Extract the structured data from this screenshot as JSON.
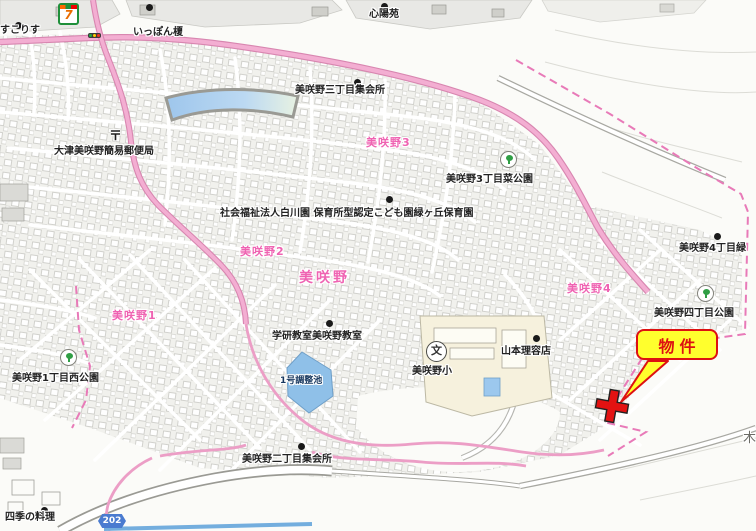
{
  "map": {
    "title": "美咲野住宅地図",
    "callout": {
      "text": "物件"
    },
    "road_badge": {
      "text": "202"
    },
    "colors": {
      "district_pink": "#ef63b2",
      "road_pink": "#f3aed2",
      "boundary_pink": "#e87ab8",
      "water_blue": "#8fc0e8",
      "callout_yellow": "#ffff2d",
      "callout_red": "#dd1111",
      "marker_red": "#e31212"
    },
    "labels": [
      {
        "text": "すこりす",
        "cls": "place",
        "x": 0,
        "y": 25
      },
      {
        "text": "いっぽん榎",
        "cls": "place",
        "x": 133,
        "y": 27
      },
      {
        "text": "心陽苑",
        "cls": "place",
        "x": 369,
        "y": 9
      },
      {
        "text": "美咲野三丁目集会所",
        "cls": "place",
        "x": 295,
        "y": 85
      },
      {
        "text": "美咲野3",
        "cls": "district",
        "x": 366,
        "y": 137
      },
      {
        "text": "美咲野3丁目菜公園",
        "cls": "place",
        "x": 446,
        "y": 174
      },
      {
        "text": "大津美咲野簡易郵便局",
        "cls": "place",
        "x": 54,
        "y": 146
      },
      {
        "text": "社会福祉法人白川園 保育所型認定こども園緑ヶ丘保育園",
        "cls": "place",
        "x": 220,
        "y": 208
      },
      {
        "text": "美咲野2",
        "cls": "district",
        "x": 240,
        "y": 246
      },
      {
        "text": "美咲野",
        "cls": "district-large",
        "x": 299,
        "y": 271
      },
      {
        "text": "美咲野4",
        "cls": "district",
        "x": 567,
        "y": 283
      },
      {
        "text": "美咲野4丁目緑",
        "cls": "place",
        "x": 679,
        "y": 243
      },
      {
        "text": "美咲野四丁目公園",
        "cls": "place",
        "x": 654,
        "y": 308
      },
      {
        "text": "美咲野1",
        "cls": "district",
        "x": 112,
        "y": 310
      },
      {
        "text": "学研教室美咲野教室",
        "cls": "place",
        "x": 272,
        "y": 331
      },
      {
        "text": "美咲野小",
        "cls": "place",
        "x": 412,
        "y": 366
      },
      {
        "text": "山本理容店",
        "cls": "place",
        "x": 501,
        "y": 346
      },
      {
        "text": "1号調整池",
        "cls": "water",
        "x": 280,
        "y": 377
      },
      {
        "text": "美咲野1丁目西公園",
        "cls": "place",
        "x": 12,
        "y": 373
      },
      {
        "text": "美咲野二丁目集会所",
        "cls": "place",
        "x": 242,
        "y": 454
      },
      {
        "text": "四季の料理",
        "cls": "place",
        "x": 5,
        "y": 512
      },
      {
        "text": "木",
        "cls": "gray-large",
        "x": 743,
        "y": 432
      }
    ],
    "icons": [
      {
        "type": "seven-eleven",
        "glyph": "7",
        "x": 58,
        "y": 3
      },
      {
        "type": "traffic-signal",
        "glyph": "",
        "x": 88,
        "y": 33
      },
      {
        "type": "post-office",
        "glyph": "〒",
        "x": 109,
        "y": 125
      },
      {
        "type": "school",
        "glyph": "文",
        "x": 426,
        "y": 341
      },
      {
        "type": "park",
        "glyph": "",
        "x": 500,
        "y": 151
      },
      {
        "type": "park",
        "glyph": "",
        "x": 697,
        "y": 285
      },
      {
        "type": "park",
        "glyph": "",
        "x": 60,
        "y": 349
      },
      {
        "type": "poi-dot",
        "glyph": "",
        "x": 15,
        "y": 22
      },
      {
        "type": "poi-dot",
        "glyph": "",
        "x": 146,
        "y": 4
      },
      {
        "type": "poi-dot",
        "glyph": "",
        "x": 381,
        "y": 3
      },
      {
        "type": "poi-dot",
        "glyph": "",
        "x": 354,
        "y": 79
      },
      {
        "type": "poi-dot",
        "glyph": "",
        "x": 386,
        "y": 196
      },
      {
        "type": "poi-dot",
        "glyph": "",
        "x": 326,
        "y": 320
      },
      {
        "type": "poi-dot",
        "glyph": "",
        "x": 533,
        "y": 335
      },
      {
        "type": "poi-dot",
        "glyph": "",
        "x": 298,
        "y": 443
      },
      {
        "type": "poi-dot",
        "glyph": "",
        "x": 41,
        "y": 507
      },
      {
        "type": "poi-dot",
        "glyph": "",
        "x": 714,
        "y": 233
      }
    ]
  }
}
